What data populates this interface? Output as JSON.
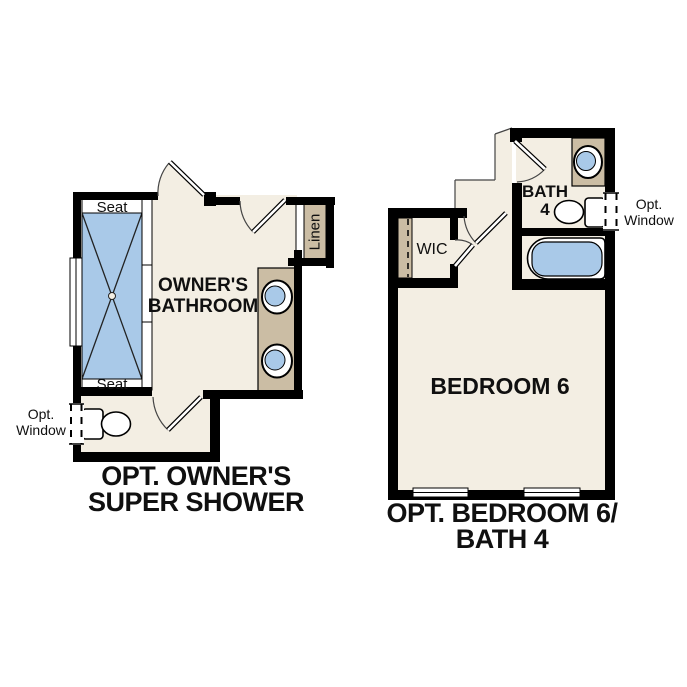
{
  "colors": {
    "floor": "#f3eee3",
    "counter": "#cbbda4",
    "fixture_blue": "#a9c9e8",
    "wall": "#000000",
    "text": "#101010"
  },
  "left_plan": {
    "room_label": [
      "OWNER'S",
      "BATHROOM"
    ],
    "seat_top": "Seat",
    "seat_bottom": "Seat",
    "linen_label": "Linen",
    "opt_window": [
      "Opt.",
      "Window"
    ],
    "caption": [
      "OPT. OWNER'S",
      "SUPER SHOWER"
    ],
    "fixtures": [
      "shower-with-seats",
      "double-sink-vanity",
      "toilet",
      "linen-closet",
      "optional-window"
    ]
  },
  "right_plan": {
    "bedroom_label": "BEDROOM 6",
    "bath_label": [
      "BATH",
      "4"
    ],
    "wic_label": "WIC",
    "opt_window": [
      "Opt.",
      "Window"
    ],
    "caption": [
      "OPT. BEDROOM 6/",
      "BATH 4"
    ],
    "fixtures": [
      "sink-vanity",
      "toilet",
      "bathtub",
      "walk-in-closet",
      "optional-window",
      "bedroom-windows"
    ]
  }
}
